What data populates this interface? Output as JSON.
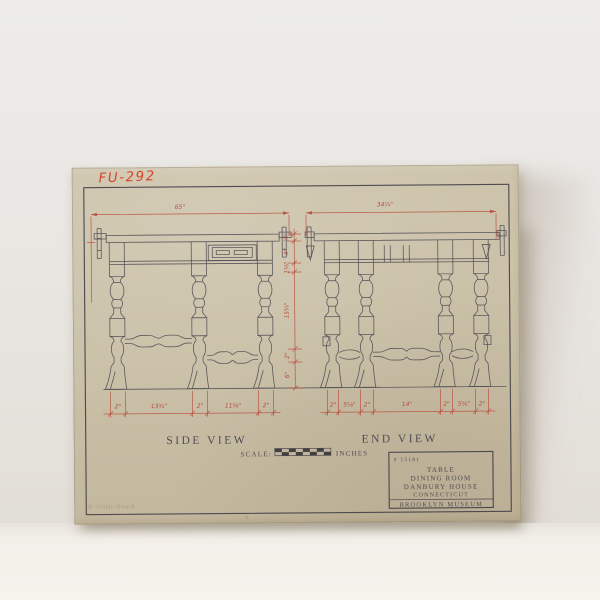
{
  "photo": {
    "wall_color": "#e9e6e2",
    "surface_color": "#f4f1eb",
    "paper_color": "#c9bfa6"
  },
  "sheet": {
    "catalog_no": "FU-292",
    "pencil_note": "B. Holst-Gould",
    "pencil_mark": "k"
  },
  "drawing": {
    "ink_color": "#4c4a52",
    "dim_color": "#b84a3a",
    "side_view": {
      "label": "SIDE VIEW",
      "width_dim": "65\"",
      "bottom_dims": [
        "2\"",
        "13¾\"",
        "2\"",
        "11⅝\"",
        "2\""
      ]
    },
    "end_view": {
      "label": "END VIEW",
      "width_dim": "34¼\"",
      "bottom_dims": [
        "2\"",
        "5⅝\"",
        "2\"",
        "14\"",
        "2\"",
        "5⅝\"",
        "2\""
      ]
    },
    "height_dims": [
      "⅞\"",
      "4\"",
      "1⅝\"",
      "15¾\"",
      "2\"",
      "6\""
    ],
    "scale_label": {
      "prefix": "SCALE:",
      "suffix": "INCHES"
    },
    "title_block": {
      "number": "# 15181",
      "line1": "TABLE",
      "line2": "DINING ROOM",
      "line3": "DANBURY HOUSE",
      "line4": "CONNECTICUT",
      "institution": "BROOKLYN MUSEUM"
    }
  }
}
